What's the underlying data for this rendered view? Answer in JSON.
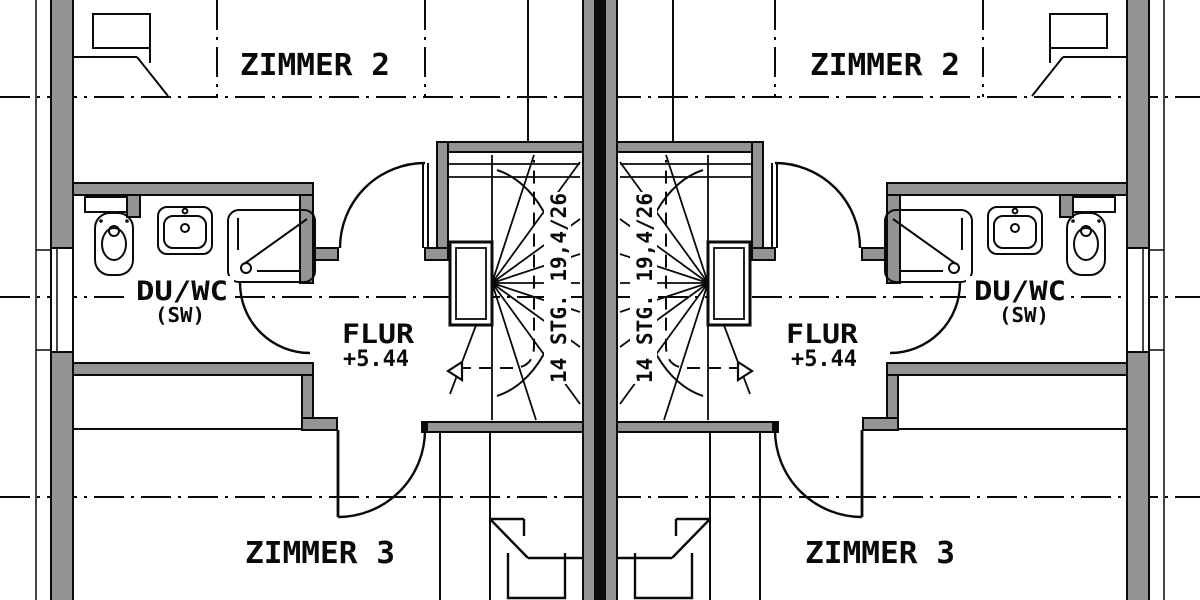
{
  "drawing": {
    "type": "floor-plan",
    "floor_level": "+5.44"
  },
  "colors": {
    "background": "#ffffff",
    "wall_fill": "#949494",
    "line": "#0a0a0a"
  },
  "units": [
    {
      "id": "left",
      "rooms": {
        "zimmer2": "ZIMMER 2",
        "zimmer3": "ZIMMER 3",
        "bath": "DU/WC",
        "bath_note": "(SW)",
        "hall": "FLUR",
        "hall_level": "+5.44"
      },
      "stair_label": "14 STG. 19,4/26"
    },
    {
      "id": "right",
      "rooms": {
        "zimmer2": "ZIMMER 2",
        "zimmer3": "ZIMMER 3",
        "bath": "DU/WC",
        "bath_note": "(SW)",
        "hall": "FLUR",
        "hall_level": "+5.44"
      },
      "stair_label": "14 STG. 19,4/26"
    }
  ]
}
